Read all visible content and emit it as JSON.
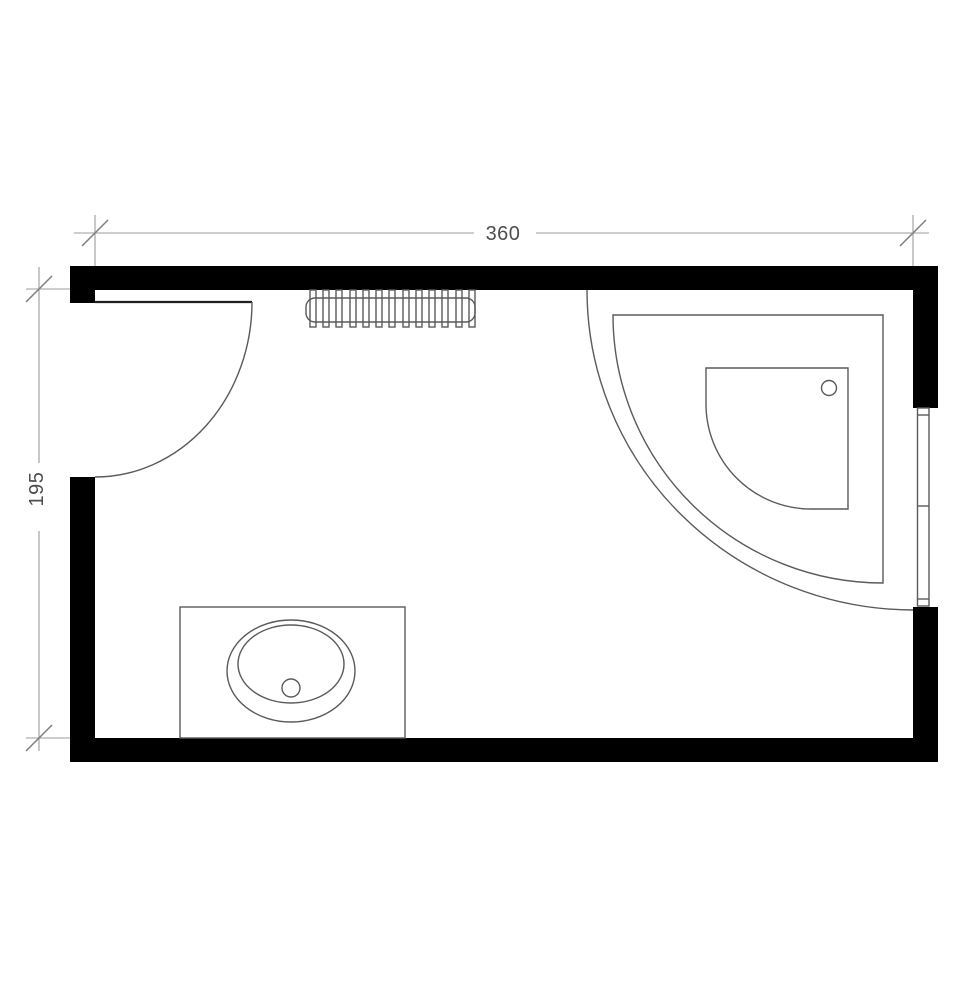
{
  "plan": {
    "kind": "bathroom-floor-plan",
    "dimension_labels": {
      "width": "360",
      "height": "195"
    },
    "fixtures": {
      "door": "hinged-door-with-swing-arc",
      "radiator": "finned-radiator",
      "shower": "quarter-circle-corner-shower",
      "window": "right-wall-window",
      "sink": "vanity-with-oval-sink"
    },
    "colors": {
      "wall": "#000000",
      "fixture": "#5a5a5a",
      "door": "#1f1f1f",
      "dim": "#9b9b9b",
      "tick": "#7e7e7e",
      "text": "#4d4d4d",
      "bg": "#ffffff"
    }
  }
}
